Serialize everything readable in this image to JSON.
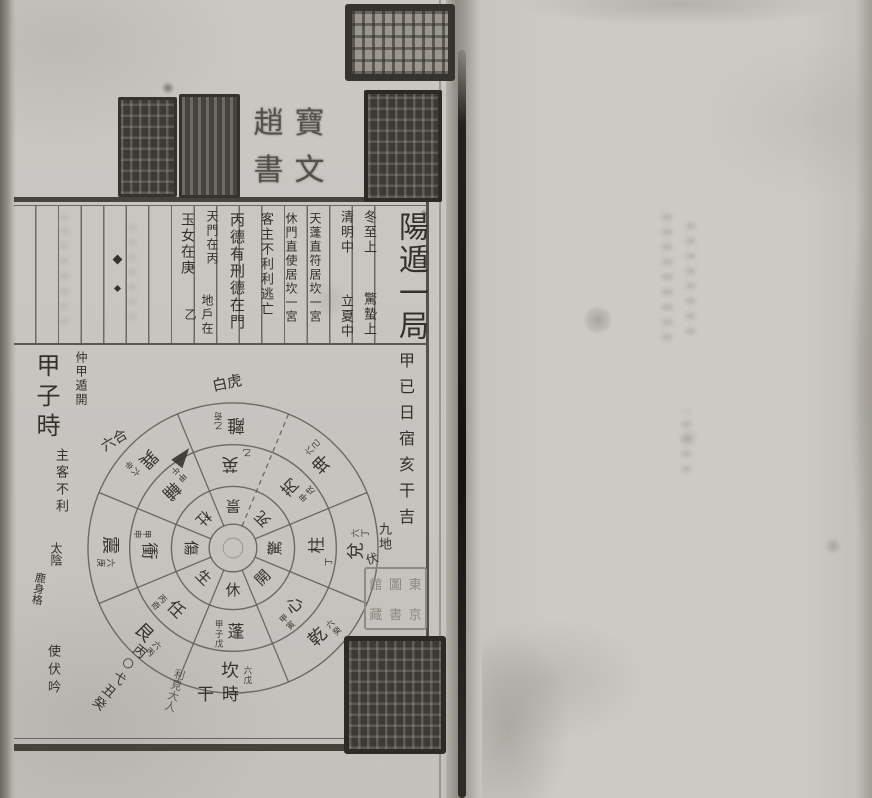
{
  "header": {
    "title": "陽遁一局",
    "columns": [
      {
        "id": "dongzhi",
        "upper": "冬至上",
        "lower": "驚蟄上"
      },
      {
        "id": "qingming",
        "upper": "清明中",
        "lower": "立夏中"
      },
      {
        "id": "tianpeng",
        "text": "天蓬直符居坎一宮"
      },
      {
        "id": "xiumen",
        "text": "休門直使居坎一宮"
      },
      {
        "id": "kezhu",
        "text": "客主不利利逃亡"
      },
      {
        "id": "bingde",
        "text": "丙德有刑德在門"
      },
      {
        "id": "tianmen",
        "upper": "天門在丙",
        "lower": "地戶在乙"
      },
      {
        "id": "yunv",
        "text": "玉女在庚"
      }
    ]
  },
  "left_notes": {
    "small": "仲甲遁開",
    "time": "甲子時",
    "below": "主客不利"
  },
  "side_note": "甲已日宿亥干吉",
  "wheel": {
    "bottom_label": "時干",
    "sectors": [
      {
        "palace": "離",
        "gate": "景",
        "star": "英",
        "star_stem": "乙",
        "palace_stem": "乙奇"
      },
      {
        "palace": "坤",
        "gate": "死",
        "star": "芮",
        "star_stem": "甲戌",
        "palace_stem": "六己"
      },
      {
        "palace": "兌",
        "gate": "驚",
        "star": "柱",
        "star_stem": "丁",
        "palace_stem": "六丁"
      },
      {
        "palace": "乾",
        "gate": "開",
        "star": "心",
        "star_stem": "甲寅",
        "palace_stem": "六癸"
      },
      {
        "palace": "坎",
        "gate": "休",
        "star": "蓬",
        "star_stem": "甲子戊",
        "palace_stem": "六戊"
      },
      {
        "palace": "艮",
        "gate": "生",
        "star": "任",
        "star_stem": "丙奇",
        "palace_stem": "六丙"
      },
      {
        "palace": "震",
        "gate": "傷",
        "star": "衝",
        "star_stem": "甲申",
        "palace_stem": "六庚"
      },
      {
        "palace": "巽",
        "gate": "杜",
        "star": "輔",
        "star_stem": "甲午",
        "palace_stem": "六辛"
      }
    ]
  },
  "annotations": [
    {
      "id": "baihu",
      "text": "白虎"
    },
    {
      "id": "liuhe",
      "text": "六合"
    },
    {
      "id": "taiyin",
      "text": "太陰"
    },
    {
      "id": "lushenge",
      "text": "鹿身格"
    },
    {
      "id": "shifuyin1",
      "text": "使伏吟"
    },
    {
      "id": "diag1",
      "text": "丙○弋丑癸"
    },
    {
      "id": "lijian",
      "text": "利見大人"
    },
    {
      "id": "jiudi",
      "text": "九地"
    },
    {
      "id": "fu",
      "text": "伏"
    },
    {
      "id": "da",
      "text": "大"
    },
    {
      "id": "shifuyin2",
      "text": "時伏吟"
    }
  ],
  "seals": {
    "top_dark": {
      "legibility": "illegible seal script"
    },
    "pair_left": {
      "legibility": "illegible seal script"
    },
    "pair_right": {
      "legibility": "illegible seal script"
    },
    "four_char": {
      "chars": [
        "寶",
        "文",
        "趙",
        "書"
      ]
    },
    "tall_dark": {
      "legibility": "illegible seal script"
    },
    "library": {
      "columns": [
        [
          "東",
          "京"
        ],
        [
          "圖",
          "書"
        ],
        [
          "館",
          "藏"
        ]
      ]
    },
    "bottom_dark": {
      "legibility": "illegible seal script"
    }
  }
}
